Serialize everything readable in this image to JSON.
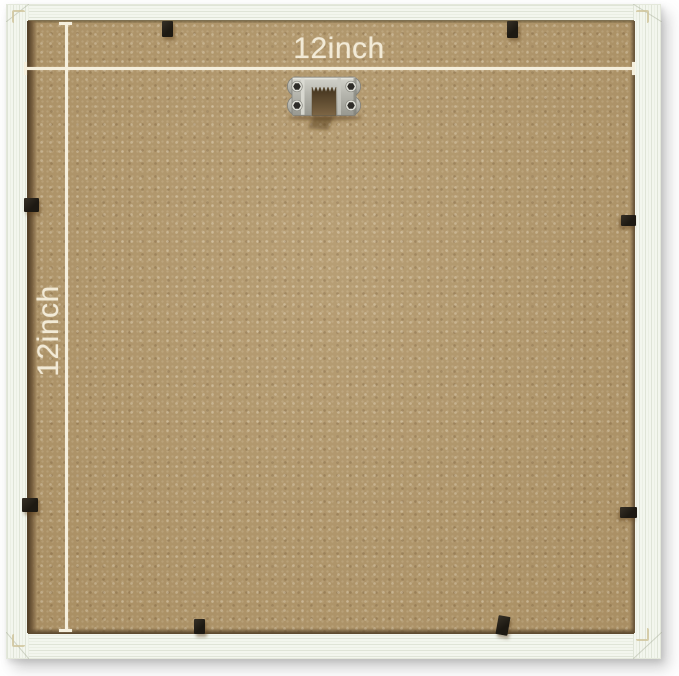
{
  "annotations": {
    "width_label": "12inch",
    "height_label": "12inch"
  },
  "hardware": {
    "hanger_icon": "sawtooth-hanger-icon",
    "retainer_tab_count": 8
  },
  "colors": {
    "background": "#ffffff",
    "frame": "#f3f6ee",
    "backing": "#b2976a",
    "annotation_text": "#f2ead6",
    "dimension_line": "#f5efdd",
    "retainer_tab": "#211d16",
    "hanger_metal": "#b5b5ad"
  }
}
